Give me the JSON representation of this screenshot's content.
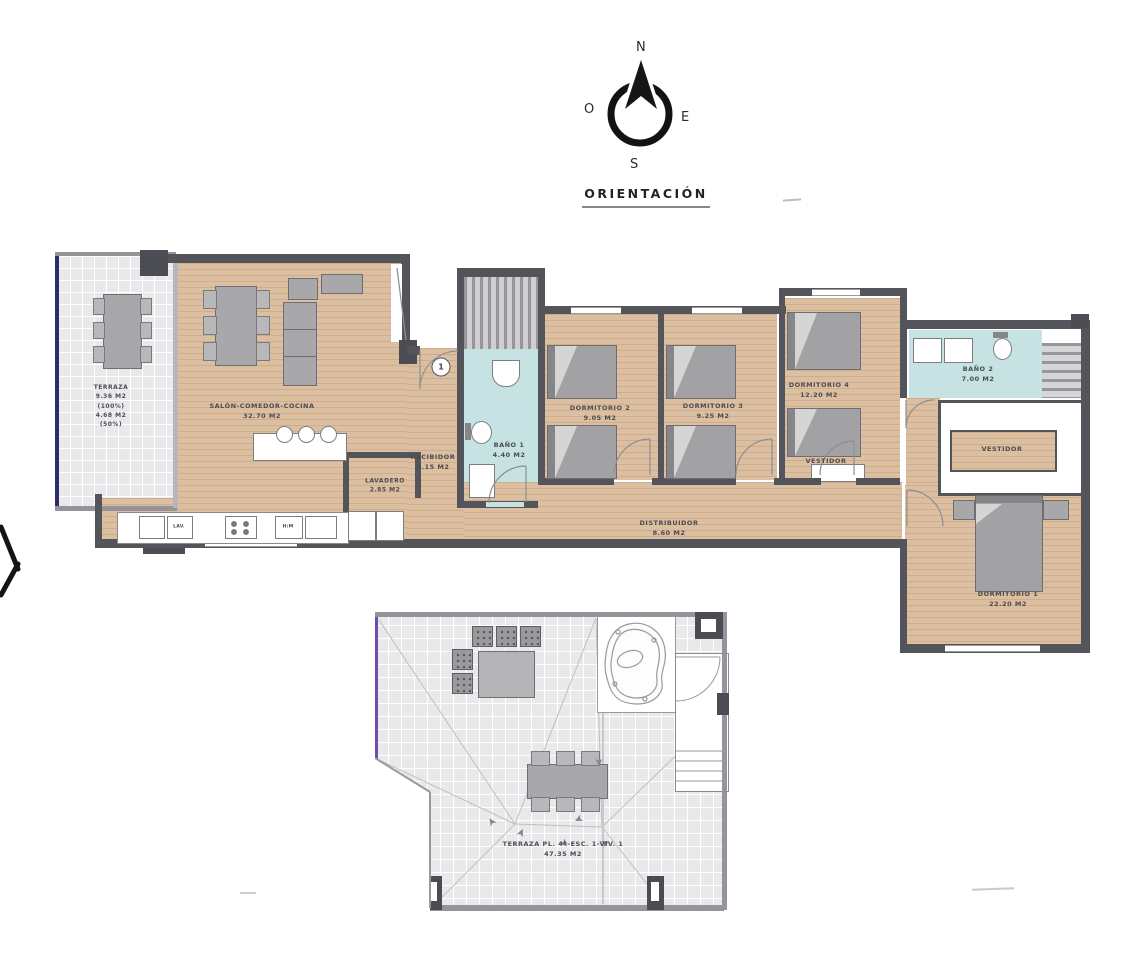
{
  "compass": {
    "north": "N",
    "east": "E",
    "south": "S",
    "west": "O",
    "title": "ORIENTACIÓN"
  },
  "floorplan": {
    "terraza": {
      "name": "TERRAZA",
      "area": "9.36 M2",
      "pct_full": "(100%)",
      "area_half": "4.68 M2",
      "pct_half": "(50%)"
    },
    "salon": {
      "name": "SALÓN-COMEDOR-COCINA",
      "area": "32.70 M2"
    },
    "recibidor": {
      "name": "RECIBIDOR",
      "area": "5.15 M2"
    },
    "lavadero": {
      "name": "LAVADERO",
      "area": "2.85 M2"
    },
    "bano1": {
      "name": "BAÑO 1",
      "area": "4.40 M2"
    },
    "dormitorio2": {
      "name": "DORMITORIO 2",
      "area": "9.05 M2"
    },
    "dormitorio3": {
      "name": "DORMITORIO 3",
      "area": "9.25 M2"
    },
    "dormitorio4": {
      "name": "DORMITORIO 4",
      "area": "12.20 M2"
    },
    "bano2": {
      "name": "BAÑO 2",
      "area": "7.00 M2"
    },
    "vestidor_dorm4": {
      "name": "VESTIDOR"
    },
    "vestidor_dorm1": {
      "name": "VESTIDOR"
    },
    "distribuidor": {
      "name": "DISTRIBUIDOR",
      "area": "8.60 M2"
    },
    "dormitorio1": {
      "name": "DORMITORIO 1",
      "area": "22.20 M2"
    },
    "kitchen": {
      "dishwasher": "LAV.",
      "oven_microwave": "H:M"
    },
    "entry_marker": "1"
  },
  "terrace_plan": {
    "name": "TERRAZA PL. 4ª-ESC. 1-VIV. 1",
    "area": "47.35 M2"
  },
  "colors": {
    "wood": "#dcbfa0",
    "tile": "#e9e9ec",
    "bath": "#c6e2e2",
    "wall": "#54555b",
    "navy_edge": "#2c2d6b",
    "violet_edge": "#6a4fb0",
    "furniture": "#a8a8aa"
  }
}
